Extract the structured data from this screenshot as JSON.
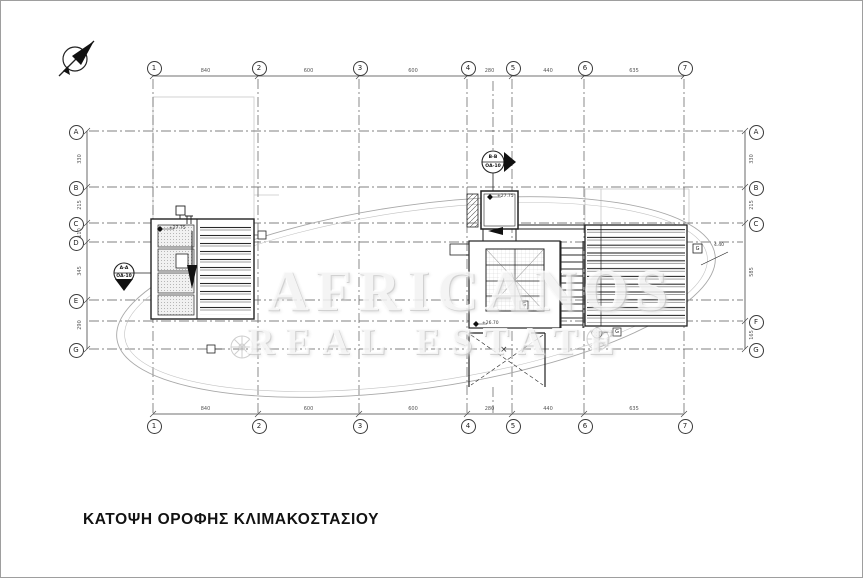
{
  "drawing": {
    "title": "ΚΑΤΟΨΗ ΟΡΟΦΗΣ ΚΛΙΜΑΚΟΣΤΑΣΙΟΥ"
  },
  "watermark": {
    "name": "AFRICANOS",
    "tagline": "REAL ESTATE"
  },
  "grid": {
    "top": [
      "1",
      "2",
      "3",
      "4",
      "5",
      "6",
      "7"
    ],
    "bottom": [
      "1",
      "2",
      "3",
      "4",
      "5",
      "6",
      "7"
    ],
    "left": [
      "A",
      "B",
      "C",
      "D",
      "E",
      "G"
    ],
    "right": [
      "A",
      "B",
      "C",
      "F",
      "G"
    ],
    "dims_top": [
      "840",
      "600",
      "600",
      "280",
      "440",
      "635"
    ],
    "dims_bottom": [
      "840",
      "600",
      "600",
      "280",
      "440",
      "635"
    ],
    "dims_left": [
      "330",
      "215",
      "110",
      "345",
      "290"
    ],
    "dims_right": [
      "330",
      "215",
      "585",
      "165"
    ]
  },
  "section_markers": {
    "a": {
      "name": "A-A",
      "sheet": "ΟΑ-10"
    },
    "b": {
      "name": "B-B",
      "sheet": "ΟΑ-10"
    }
  },
  "annotations": {
    "level_stair": "+27.75",
    "level_room": "+27.75",
    "level_lower": "+26.70",
    "curve_label": "4.40",
    "void_mark": "×",
    "grate_1": "G",
    "grate_2": "G",
    "grate_3": "G"
  },
  "colors": {
    "line": "#222222",
    "grid_line": "#5a5a5a",
    "construction": "#c8c8c8",
    "watermark": "#d9d9d9"
  }
}
